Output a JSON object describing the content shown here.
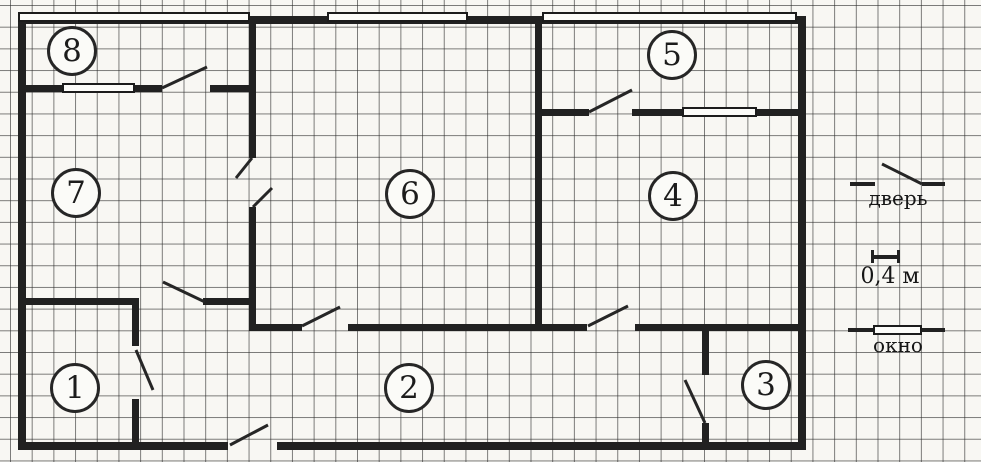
{
  "rooms": {
    "r1": "1",
    "r2": "2",
    "r3": "3",
    "r4": "4",
    "r5": "5",
    "r6": "6",
    "r7": "7",
    "r8": "8"
  },
  "legend": {
    "door_label": "дверь",
    "scale_label": "0,4 м",
    "window_label": "окно"
  },
  "colors": {
    "wall": "#212121",
    "paper": "#f8f7f3",
    "grid_line": "#2d2d2d",
    "window_fill": "#fcfcf9"
  }
}
